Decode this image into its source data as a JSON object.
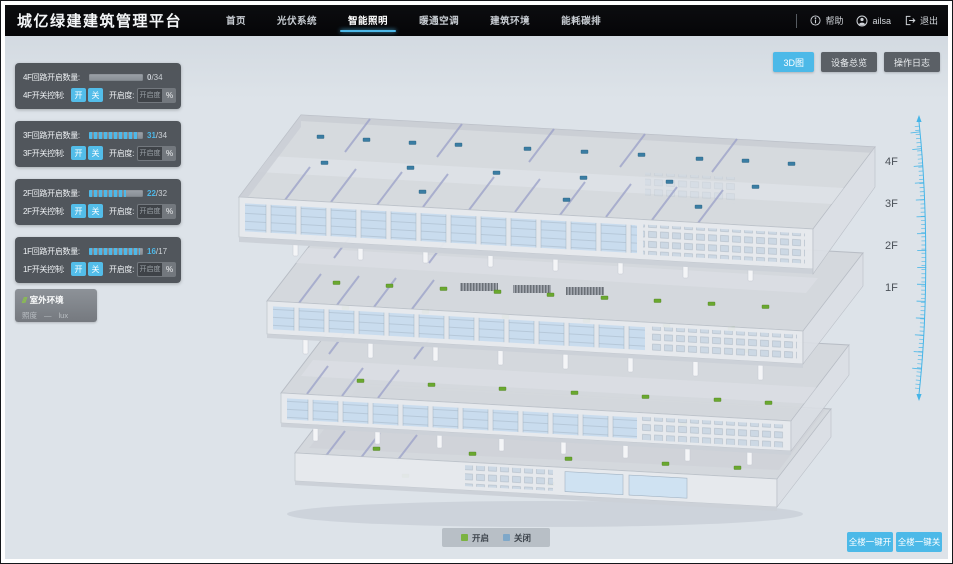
{
  "app": {
    "title": "城亿绿建建筑管理平台"
  },
  "nav": {
    "items": [
      {
        "label": "首页"
      },
      {
        "label": "光伏系统"
      },
      {
        "label": "智能照明"
      },
      {
        "label": "暖通空调"
      },
      {
        "label": "建筑环境"
      },
      {
        "label": "能耗碳排"
      }
    ],
    "active_item": "智能照明",
    "help_label": "帮助",
    "user_name": "ailsa",
    "logout_label": "退出"
  },
  "view_switcher": {
    "buttons": [
      {
        "label": "3D图"
      },
      {
        "label": "设备总览"
      },
      {
        "label": "操作日志"
      }
    ],
    "active_button": "3D图"
  },
  "floor_panels": [
    {
      "count_label": "4F回路开启数量:",
      "value": "0",
      "total": "/34",
      "pct": "0%",
      "switch_label": "4F开关控制:",
      "on_label": "开",
      "off_label": "关",
      "dim_label": "开启度:",
      "dim_placeholder": "开启度",
      "percent_label": "%"
    },
    {
      "count_label": "3F回路开启数量:",
      "value": "31",
      "total": "/34",
      "pct": "91%",
      "switch_label": "3F开关控制:",
      "on_label": "开",
      "off_label": "关",
      "dim_label": "开启度:",
      "dim_placeholder": "开启度",
      "percent_label": "%"
    },
    {
      "count_label": "2F回路开启数量:",
      "value": "22",
      "total": "/32",
      "pct": "69%",
      "switch_label": "2F开关控制:",
      "on_label": "开",
      "off_label": "关",
      "dim_label": "开启度:",
      "dim_placeholder": "开启度",
      "percent_label": "%"
    },
    {
      "count_label": "1F回路开启数量:",
      "value": "16",
      "total": "/17",
      "pct": "94%",
      "switch_label": "1F开关控制:",
      "on_label": "开",
      "off_label": "关",
      "dim_label": "开启度:",
      "dim_placeholder": "开启度",
      "percent_label": "%"
    }
  ],
  "outdoor": {
    "title": "室外环境",
    "icon": "///",
    "metric_label": "照度",
    "metric_value": "—",
    "metric_unit": "lux"
  },
  "floor_labels": [
    "4F",
    "3F",
    "2F",
    "1F"
  ],
  "legend": {
    "items": [
      {
        "label": "开启",
        "color": "#7cb342"
      },
      {
        "label": "关闭",
        "color": "#7fa8c9"
      }
    ]
  },
  "bulk_controls": {
    "all_on_label": "全楼一键开",
    "all_off_label": "全楼一键关"
  },
  "colors": {
    "accent": "#4db8e8",
    "nav_bg": "#070709",
    "marker_on": "#6aa82f",
    "marker_off": "#3a7da3",
    "background": "#dde3e9"
  }
}
